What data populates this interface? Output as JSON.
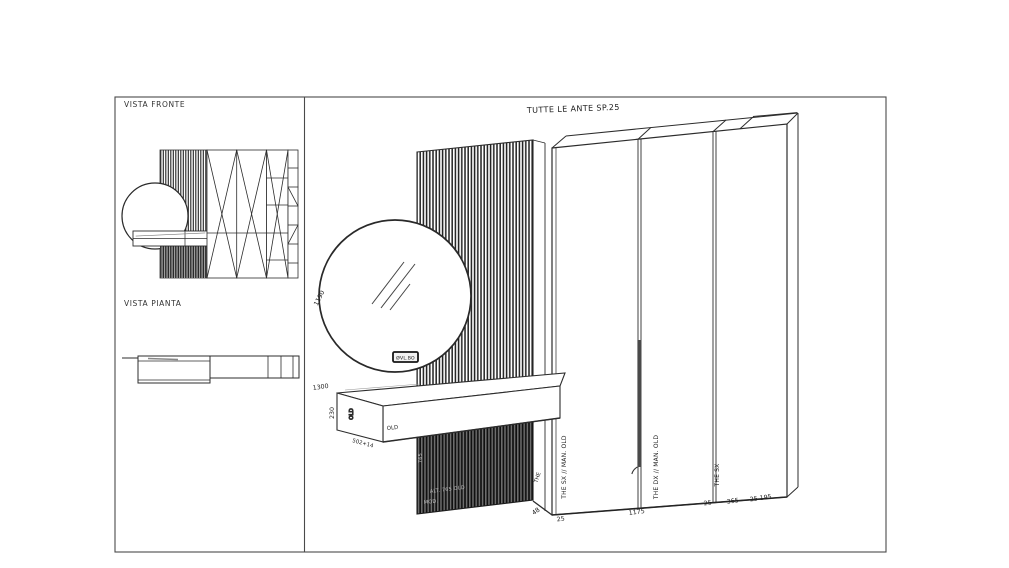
{
  "left_panel": {
    "front_view_title": "VISTA FRONTE",
    "plan_view_title": "VISTA PIANTA"
  },
  "main_panel": {
    "title": "TUTTE LE ANTE SP.25",
    "mirror": {
      "diameter": "1190",
      "height": "1300",
      "badge": "ØVL.BO"
    },
    "console": {
      "thickness": "230",
      "side_finish": "OLD",
      "front_finish": "OLD",
      "depth": "502+14"
    },
    "slat_panel": {
      "height": "765",
      "note_line1": "ALT. 765 OLD",
      "note_line2": "MOD."
    },
    "wardrobe": {
      "side_label": "THE",
      "door_left_label": "THE  SX // MAN. OLD",
      "door_right_label": "THE  DX // MAN. OLD",
      "side_panel_label": "THE  SX",
      "dim_side_depth": "48",
      "dim_gap_left": "25",
      "dim_doors_width": "1175",
      "dim_gap_right": "25",
      "dim_side_width": "365",
      "dim_end": "25 195"
    }
  },
  "colors": {
    "line": "#2c2c2c",
    "frame": "#4a4a4a",
    "slat_dark_bg": "#6e6e6e"
  }
}
